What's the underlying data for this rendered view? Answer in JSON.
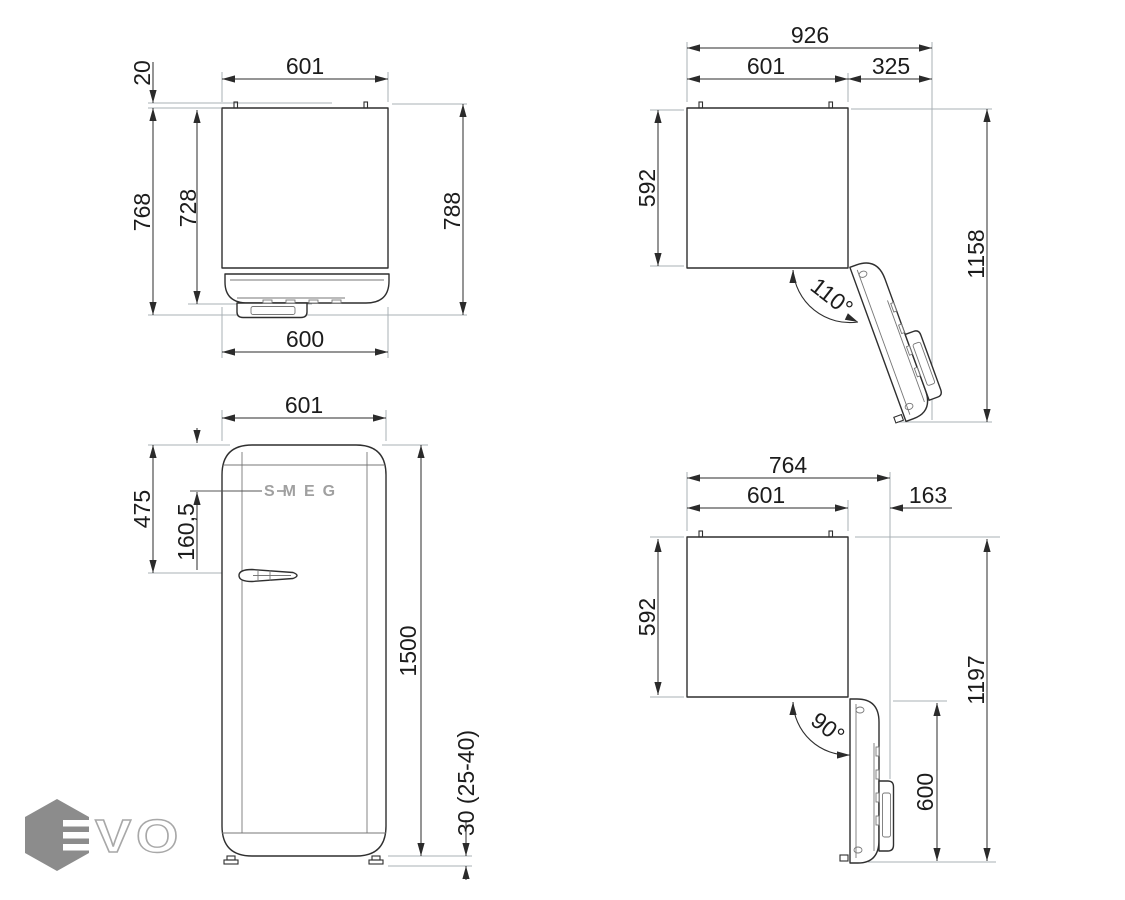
{
  "colors": {
    "line": "#2f2f2f",
    "extension_line": "#a9b0b5",
    "detail_line": "#777777",
    "logo_hexagon": "#8c8c8c",
    "logo_letters": "#a0a0a0",
    "background": "#ffffff"
  },
  "views": {
    "top_closed": {
      "width_top": "601",
      "rear_clearance": "20",
      "depth_cabinet": "728",
      "depth_body": "768",
      "depth_total": "788",
      "width_bottom": "600"
    },
    "open_110": {
      "total_width": "926",
      "body_width": "601",
      "door_projection": "325",
      "body_depth": "592",
      "total_depth": "1158",
      "angle": "110°"
    },
    "front": {
      "width": "601",
      "handle_from_top": "475",
      "logo_from_top": "160,5",
      "height": "1500",
      "feet_height": "30 (25-40)",
      "logo": "SMEG"
    },
    "open_90": {
      "total_width": "764",
      "body_width": "601",
      "door_projection": "163",
      "body_depth": "592",
      "total_depth": "1197",
      "door_width": "600",
      "angle": "90°"
    }
  },
  "watermark": {
    "text": "VO"
  }
}
